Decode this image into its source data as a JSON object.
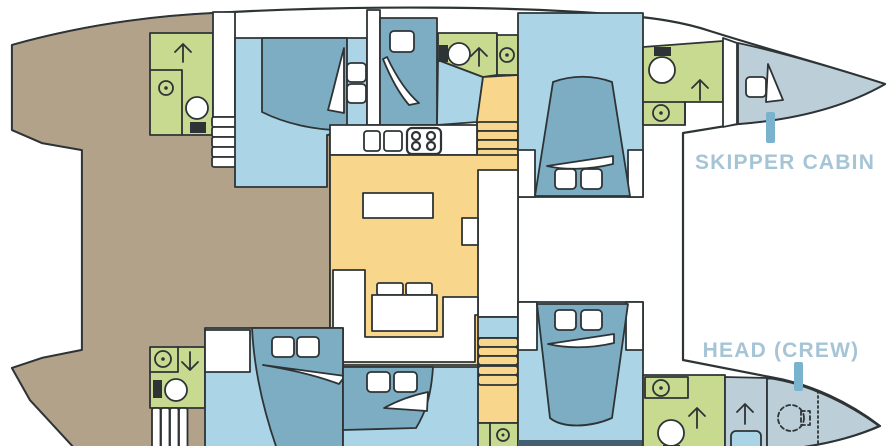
{
  "figure": {
    "type": "boat-deck-plan",
    "subject": "catamaran interior layout, top view, bows to the right",
    "labels": {
      "skipper_cabin": "SKIPPER CABIN",
      "head_crew": "HEAD (CREW)"
    }
  },
  "colors": {
    "outline": "#2e3436",
    "deck": "#b3a28a",
    "salon": "#f8d68c",
    "floor": "#abd5e6",
    "bed": "#7cadc3",
    "bow": "#bccfd9",
    "wet": "#c8da90",
    "strip": "#44606e",
    "label": "#a5c5d7",
    "tick": "#7ab3cd",
    "white": "#ffffff"
  },
  "icons": {
    "toilet": "circle bowl with black cistern",
    "sink": "circle with center dot",
    "stove": "rounded square with 4 burner rings",
    "galley_sinks": "two rounded rectangles",
    "direction_arrow": "chevron arrow",
    "stairs": "stacked step bars",
    "bed": "trapezoid with two pillows and shelf sliver",
    "crew_toilet": "dashed circle"
  },
  "rooms": [
    "aft head (starboard)",
    "aft cabin (starboard)",
    "mid cabin (starboard)",
    "mid head (starboard)",
    "forward cabin (starboard)",
    "forward head (starboard)",
    "skipper cabin (starboard bow)",
    "galley",
    "salon with U-sofa and table",
    "companionway stairs x2",
    "aft head (port)",
    "aft cabin (port)",
    "mid cabin (port)",
    "lower head (port)",
    "forward cabin (port)",
    "forward head (port)",
    "crew head (port bow)",
    "aft deck / cockpit"
  ]
}
